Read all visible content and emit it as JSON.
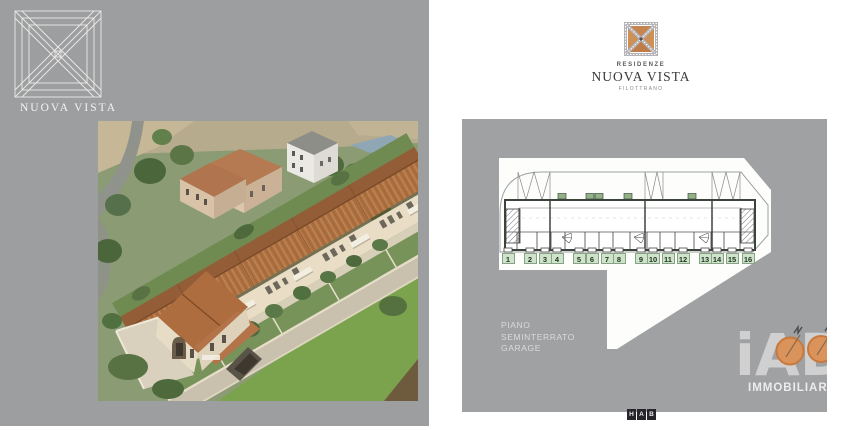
{
  "brand": {
    "left_logo": {
      "title": "NUOVA VISTA"
    },
    "right_logo": {
      "residenze": "RESIDENZE",
      "title": "NUOVA VISTA",
      "subtitle": "FILOTTRANO",
      "accent_color": "#c6854f",
      "band_color": "#b5b3b8"
    }
  },
  "plan": {
    "floor_label_lines": [
      "PIANO",
      "SEMINTERRATO",
      "GARAGE"
    ],
    "unit_numbers": [
      "1",
      "2",
      "3",
      "4",
      "5",
      "6",
      "7",
      "8",
      "9",
      "10",
      "11",
      "12",
      "13",
      "14",
      "15",
      "16"
    ],
    "badge_bg_color": "#cfe2cc",
    "badge_text_color": "#21381f",
    "panel_color": "#a0a1a3"
  },
  "watermark": {
    "big_text": "iAD",
    "word": "IMMOBILIARE",
    "orange": "#db935c"
  },
  "footer_logo": {
    "letters": [
      "H",
      "A",
      "B"
    ]
  },
  "colors": {
    "left_panel": "#9d9e9f",
    "roof_terracotta": "#b0713f",
    "wall_cream": "#e9ddc6"
  }
}
